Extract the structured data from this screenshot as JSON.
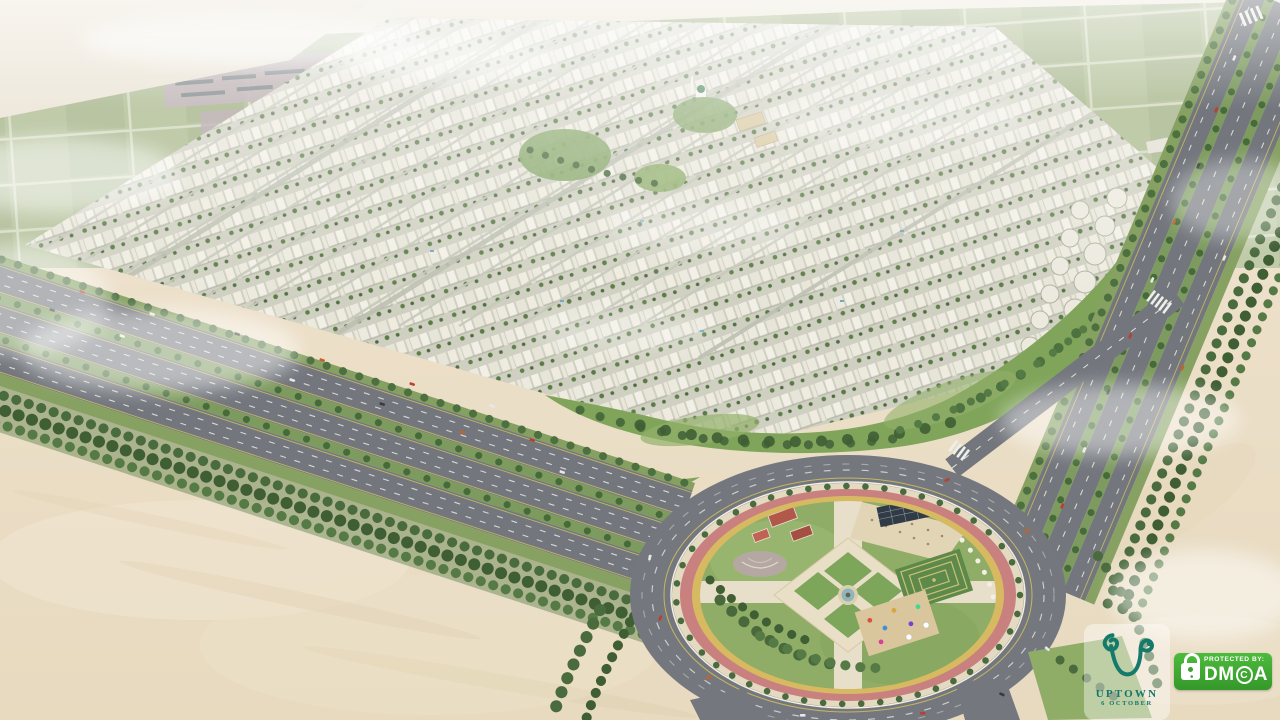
{
  "palette": {
    "sky_haze": "#f1ede3",
    "farmland_green": "#b6c39d",
    "farmland_road": "#d7dcc4",
    "desert_sand": "#e9dec5",
    "building_white": "#eceade",
    "asphalt_road": "#74787e",
    "tree_green": "#4a6b3e",
    "lawn_green": "#86a763",
    "running_track_pink": "#c98180",
    "park_ring_yellow": "#d7b961",
    "logo_teal": "#157a6b",
    "dmca_green": "#3fae32"
  },
  "icons": {
    "uptown_monogram": "teal curled-U monogram",
    "padlock_icon": "white padlock with green keyhole"
  },
  "logo": {
    "brand": "UPTOWN",
    "subtitle": "6 OCTOBER"
  },
  "dmca": {
    "protected_by": "PROTECTED BY:",
    "brand_dm": "DM",
    "brand_c": "C",
    "brand_a": "A"
  }
}
